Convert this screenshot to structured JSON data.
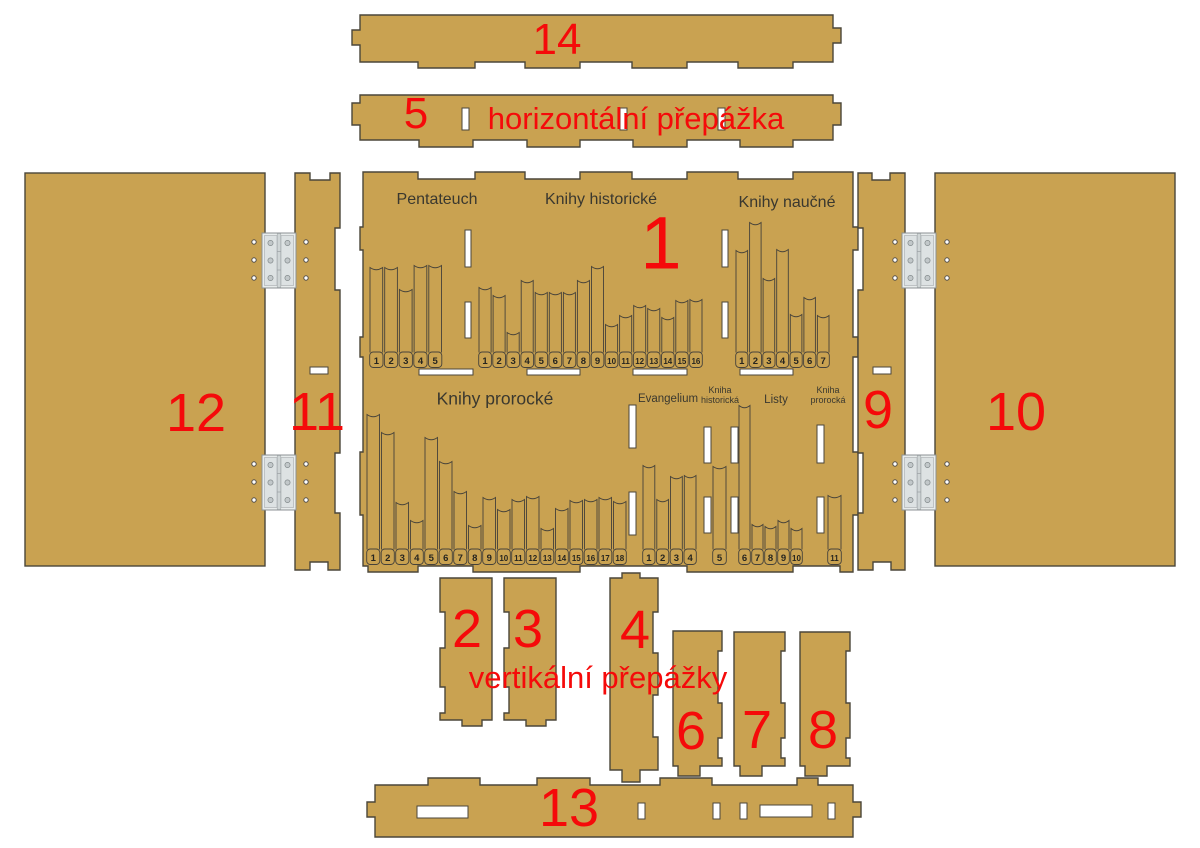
{
  "captions": {
    "horizontal_divider": "horizontální přepážka",
    "vertical_dividers": "vertikální přepážky"
  },
  "part_numbers": {
    "p1": "1",
    "p2": "2",
    "p3": "3",
    "p4": "4",
    "p5": "5",
    "p6": "6",
    "p7": "7",
    "p8": "8",
    "p9": "9",
    "p10": "10",
    "p11": "11",
    "p12": "12",
    "p13": "13",
    "p14": "14"
  },
  "colors": {
    "wood": "#c9a251",
    "outline": "#4b463a",
    "red": "#f50a0a",
    "label_text": "#3a382f",
    "cutout": "#ffffff",
    "hinge": "#e1e5e6"
  },
  "bookshelf": {
    "rows": [
      {
        "groups": [
          {
            "name": "Pentateuch",
            "first_number": 1,
            "book_heights": [
              87,
              87,
              65,
              89,
              89
            ]
          },
          {
            "name": "Knihy historické",
            "first_number": 1,
            "book_heights": [
              67,
              59,
              22,
              74,
              62,
              62,
              62,
              74,
              88,
              30,
              39,
              49,
              46,
              37,
              54,
              55
            ]
          },
          {
            "name": "Knihy naučné",
            "first_number": 1,
            "book_heights": [
              104,
              132,
              76,
              105,
              40,
              57,
              39
            ]
          }
        ]
      },
      {
        "groups": [
          {
            "name": "Knihy prorocké",
            "first_number": 1,
            "book_heights": [
              137,
              119,
              49,
              31,
              114,
              90,
              60,
              26,
              54,
              42,
              52,
              55,
              23,
              43,
              51,
              52,
              54,
              50
            ]
          },
          {
            "name": "Evangelium",
            "first_number": 1,
            "book_heights": [
              86,
              52,
              75,
              76
            ]
          },
          {
            "name": "Kniha historická",
            "first_number": 5,
            "book_heights": [
              85
            ]
          },
          {
            "name": "Listy",
            "first_number": 6,
            "book_heights": [
              146,
              27,
              25,
              31,
              23
            ]
          },
          {
            "name": "Kniha prorocká",
            "first_number": 11,
            "book_heights": [
              56
            ]
          }
        ]
      }
    ]
  }
}
